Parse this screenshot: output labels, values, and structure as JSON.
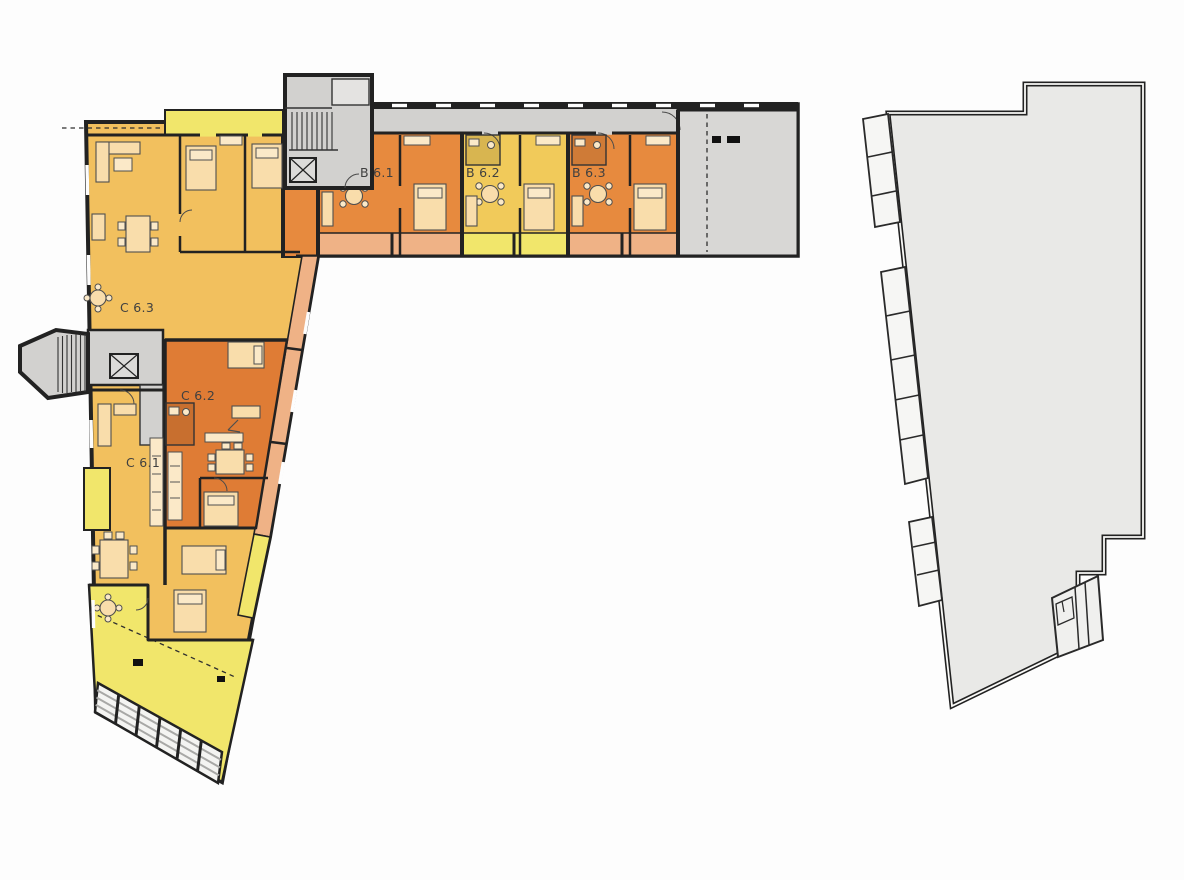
{
  "canvas": {
    "background": "#fdfdfd"
  },
  "palette": {
    "wall": "#222222",
    "gray": "#d2d1cf",
    "grayblock": "#d8d7d5",
    "adjacent": "#e9e9e7",
    "amber": "#f2c05e",
    "orange": "#e78a3e",
    "orangedeep": "#df7c35",
    "yellow": "#f1e66b",
    "yellowsoft": "#f1ca5a",
    "salmon": "#efb286",
    "furniture": "#f9ddab",
    "label": "#404040",
    "paper": "#fdfdfd"
  },
  "buildings": {
    "main": {
      "units": [
        {
          "id": "b61",
          "label": "B 6.1"
        },
        {
          "id": "b62",
          "label": "B 6.2"
        },
        {
          "id": "b63",
          "label": "B 6.3"
        },
        {
          "id": "c61",
          "label": "C 6.1"
        },
        {
          "id": "c62",
          "label": "C 6.2"
        },
        {
          "id": "c63",
          "label": "C 6.3"
        }
      ],
      "symbols": [
        "staircase",
        "elevator",
        "garage-louvers",
        "terrace",
        "balcony"
      ]
    },
    "adjacent": {
      "symbols": [
        "balcony-band",
        "entrance-detail"
      ]
    }
  }
}
